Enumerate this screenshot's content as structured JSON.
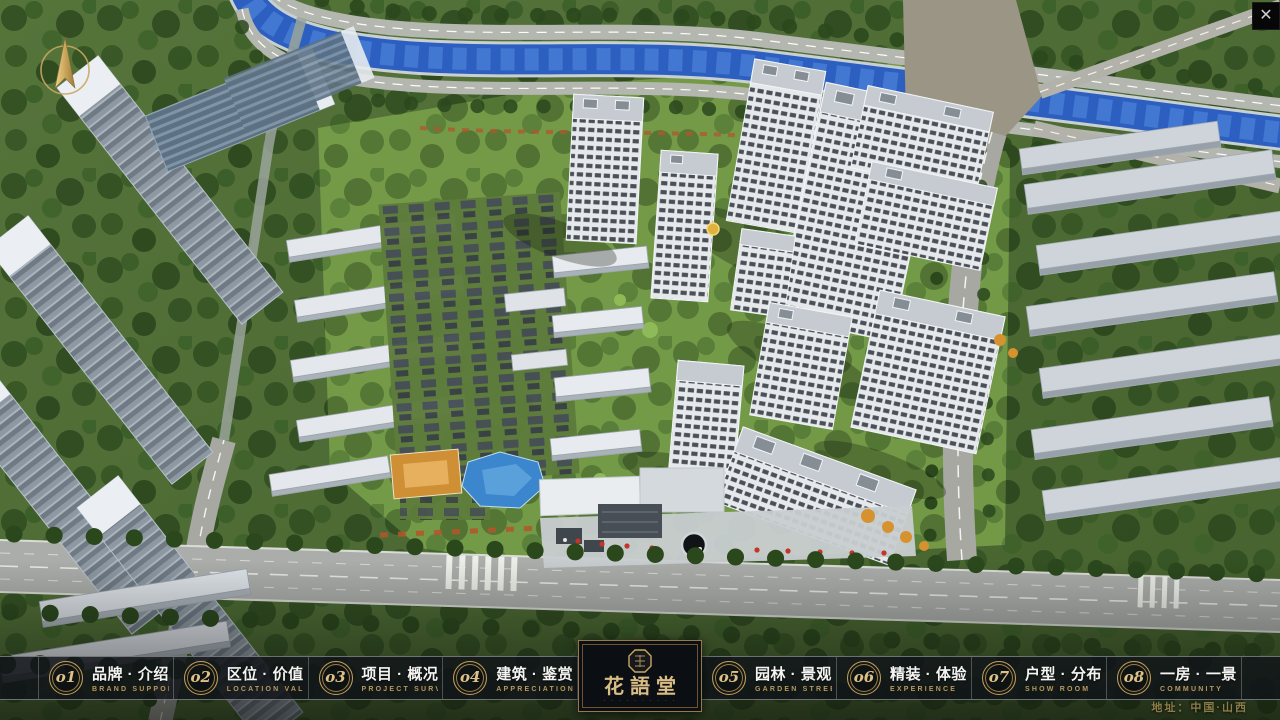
{
  "nav": {
    "items": [
      {
        "num": "o1",
        "title": "品牌 · 介绍",
        "subtitle": "BRAND SUPPORT"
      },
      {
        "num": "o2",
        "title": "区位 · 价值",
        "subtitle": "LOCATION VALUE"
      },
      {
        "num": "o3",
        "title": "项目 · 概况",
        "subtitle": "PROJECT SURVEY"
      },
      {
        "num": "o4",
        "title": "建筑 · 鉴赏",
        "subtitle": "APPRECIATION"
      },
      {
        "num": "o5",
        "title": "园林 · 景观",
        "subtitle": "GARDEN STREET"
      },
      {
        "num": "o6",
        "title": "精装 · 体验",
        "subtitle": "EXPERIENCE"
      },
      {
        "num": "o7",
        "title": "户型 · 分布",
        "subtitle": "SHOW ROOM"
      },
      {
        "num": "o8",
        "title": "一房 · 一景",
        "subtitle": "COMMUNITY"
      }
    ],
    "logo": {
      "name": "花語堂",
      "tagline": "· · · · · · · · · ·"
    }
  },
  "footer": {
    "address": "地址：中国·山西"
  },
  "icons": {
    "close": "✕"
  },
  "colors": {
    "gold": "#c0a163",
    "gold_bright": "#ddc187",
    "bar_background": "rgba(16,20,24,0.82)",
    "panel_background": "#0b0e12",
    "river_blue": "#2d5fc0"
  }
}
